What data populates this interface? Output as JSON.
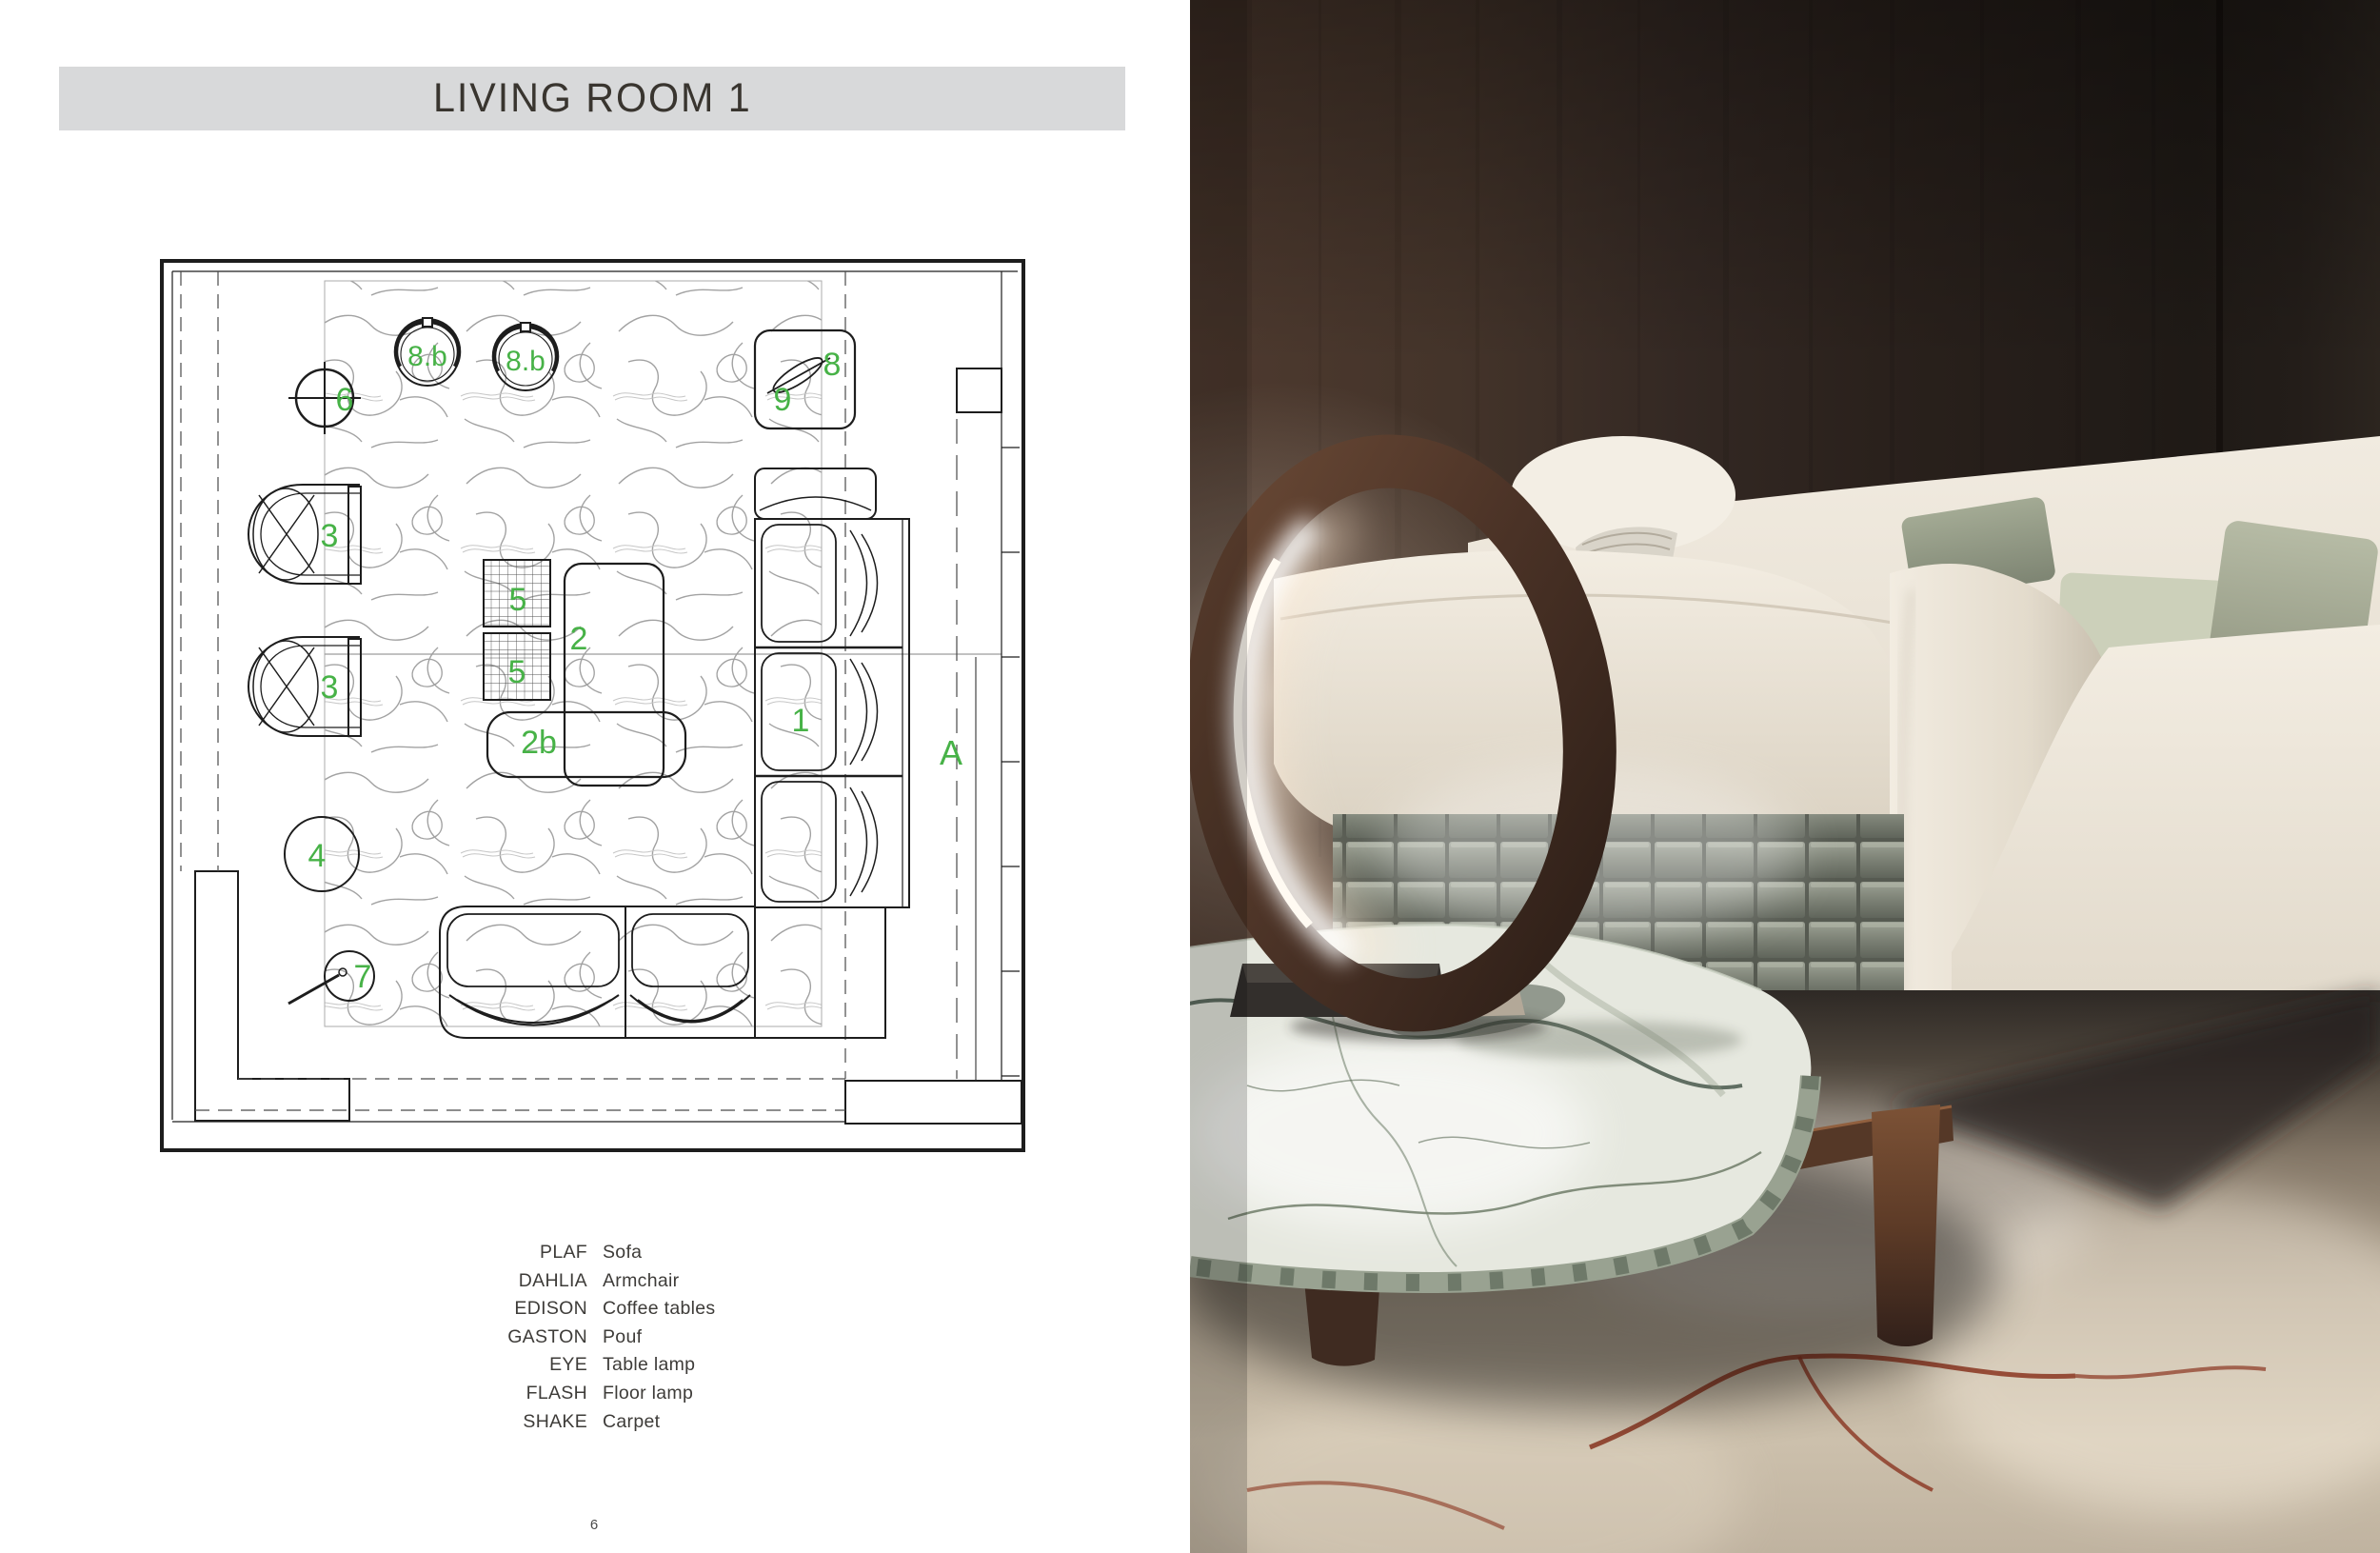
{
  "header": {
    "title": "LIVING ROOM 1",
    "bar_color": "#d8d9da"
  },
  "page": {
    "number": "6"
  },
  "plan": {
    "accent_green": "#47b247",
    "line_color": "#1d1d1d",
    "labels": {
      "sofa": "1",
      "coffee_table_tall": "2",
      "coffee_table_low": "2b",
      "armchair_top": "3",
      "armchair_bottom": "3",
      "pouf": "4",
      "side_table_top": "5",
      "side_table_bottom": "5",
      "lamp_table": "6",
      "floor_lamp": "7",
      "side_table_right": "8",
      "pendant_left": "8.b",
      "pendant_right": "8.b",
      "leaf_decor": "9",
      "section_marker": "A"
    }
  },
  "legend": {
    "items": [
      {
        "name": "PLAF",
        "type": "Sofa"
      },
      {
        "name": "DAHLIA",
        "type": "Armchair"
      },
      {
        "name": "EDISON",
        "type": "Coffee tables"
      },
      {
        "name": "GASTON",
        "type": "Pouf"
      },
      {
        "name": "EYE",
        "type": "Table lamp"
      },
      {
        "name": "FLASH",
        "type": "Floor lamp"
      },
      {
        "name": "SHAKE",
        "type": "Carpet"
      }
    ]
  },
  "photo": {
    "wall_wood_dark": "#3b2d25",
    "sofa_ivory": "#ece6da",
    "pillow_sage": "#9aa18c",
    "leather_weave_green": "#7c8175",
    "marble_light": "#e6e8df",
    "carpet_beige": "#c0b3a0",
    "carpet_vein_red": "#8a3520",
    "ring_wood": "#53392b"
  }
}
